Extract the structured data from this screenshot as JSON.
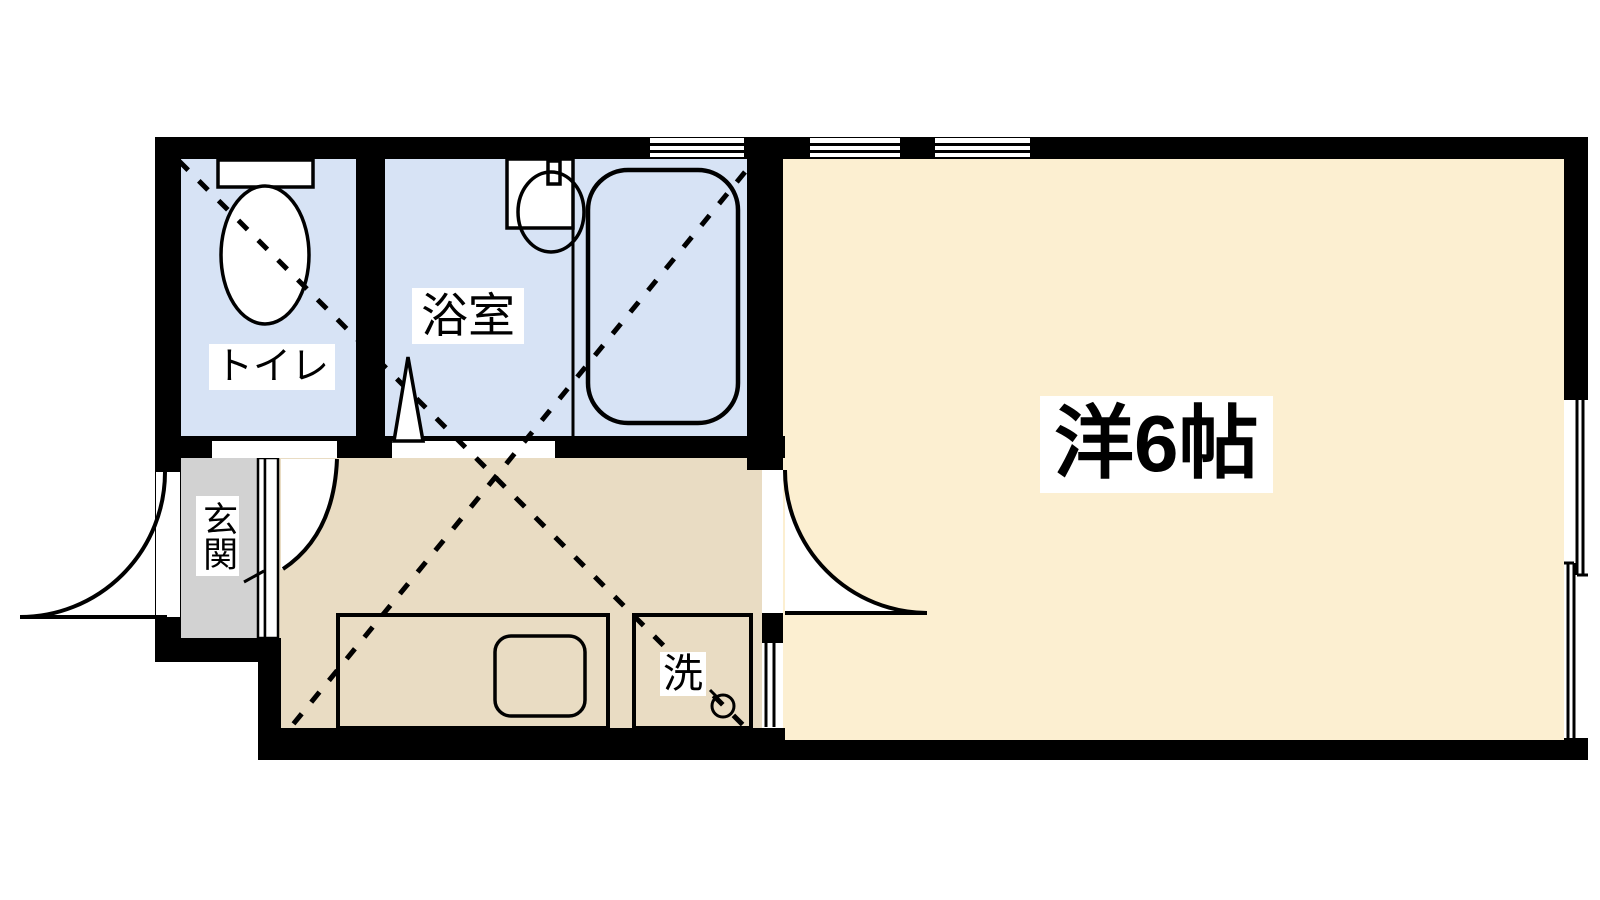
{
  "diagram_type": "apartment-floor-plan",
  "rooms": {
    "toilet": "トイレ",
    "bathroom": "浴室",
    "entrance": "玄関",
    "laundry": "洗",
    "main_room": "洋6帖"
  },
  "colors": {
    "wall": "#000000",
    "line": "#000000",
    "wet_area_floor": "#d7e3f5",
    "kitchen_floor": "#e9dcc3",
    "main_room_floor": "#fcefd1",
    "entrance_floor": "#d2d2d2",
    "fixture_fill": "#ffffff",
    "background": "#ffffff"
  }
}
